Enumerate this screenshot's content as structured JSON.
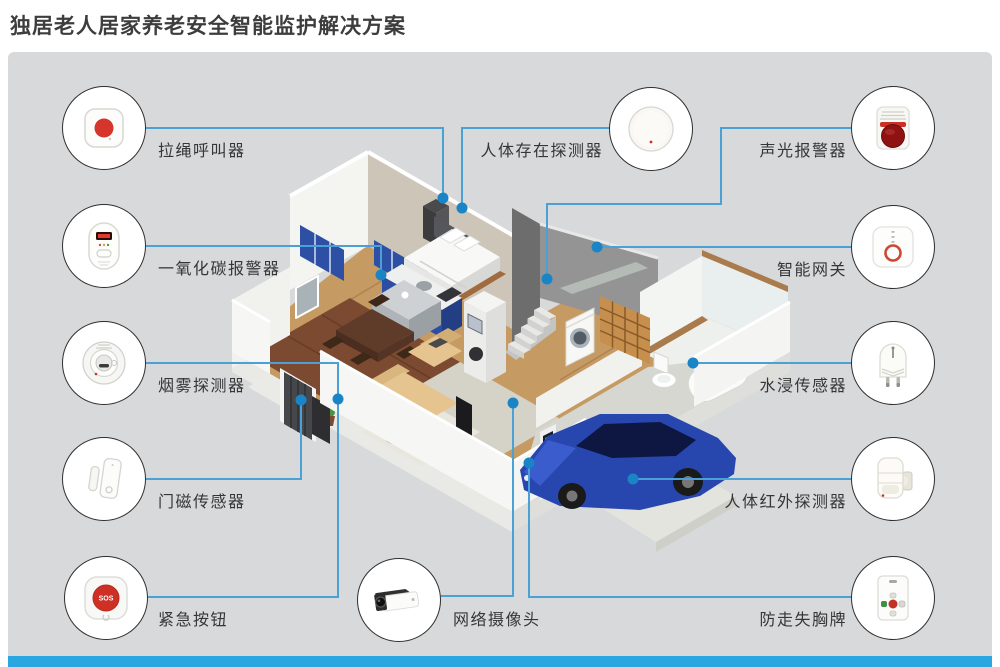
{
  "title": "独居老人居家养老安全智能监护解决方案",
  "devices": [
    {
      "id": "pull-cord-caller",
      "label": "拉绳呼叫器",
      "side": "left"
    },
    {
      "id": "co-alarm",
      "label": "一氧化碳报警器",
      "side": "left"
    },
    {
      "id": "smoke-detector",
      "label": "烟雾探测器",
      "side": "left"
    },
    {
      "id": "door-sensor",
      "label": "门磁传感器",
      "side": "left"
    },
    {
      "id": "emergency-button",
      "label": "紧急按钮",
      "side": "left"
    },
    {
      "id": "presence-detector",
      "label": "人体存在探测器",
      "side": "top-middle"
    },
    {
      "id": "ip-camera",
      "label": "网络摄像头",
      "side": "bottom-middle"
    },
    {
      "id": "sound-light-alarm",
      "label": "声光报警器",
      "side": "right"
    },
    {
      "id": "smart-gateway",
      "label": "智能网关",
      "side": "right"
    },
    {
      "id": "water-leak-sensor",
      "label": "水浸传感器",
      "side": "right"
    },
    {
      "id": "pir-detector",
      "label": "人体红外探测器",
      "side": "right"
    },
    {
      "id": "anti-loss-badge",
      "label": "防走失胸牌",
      "side": "right"
    }
  ],
  "colors": {
    "connector_line": "#4BA0D6",
    "connector_dot": "#1A85C6",
    "footer_bar": "#2AA7E0",
    "panel_bg": "#D8D9DA",
    "circle_border": "#2F2F2F",
    "title_text": "#3D3D3D"
  }
}
